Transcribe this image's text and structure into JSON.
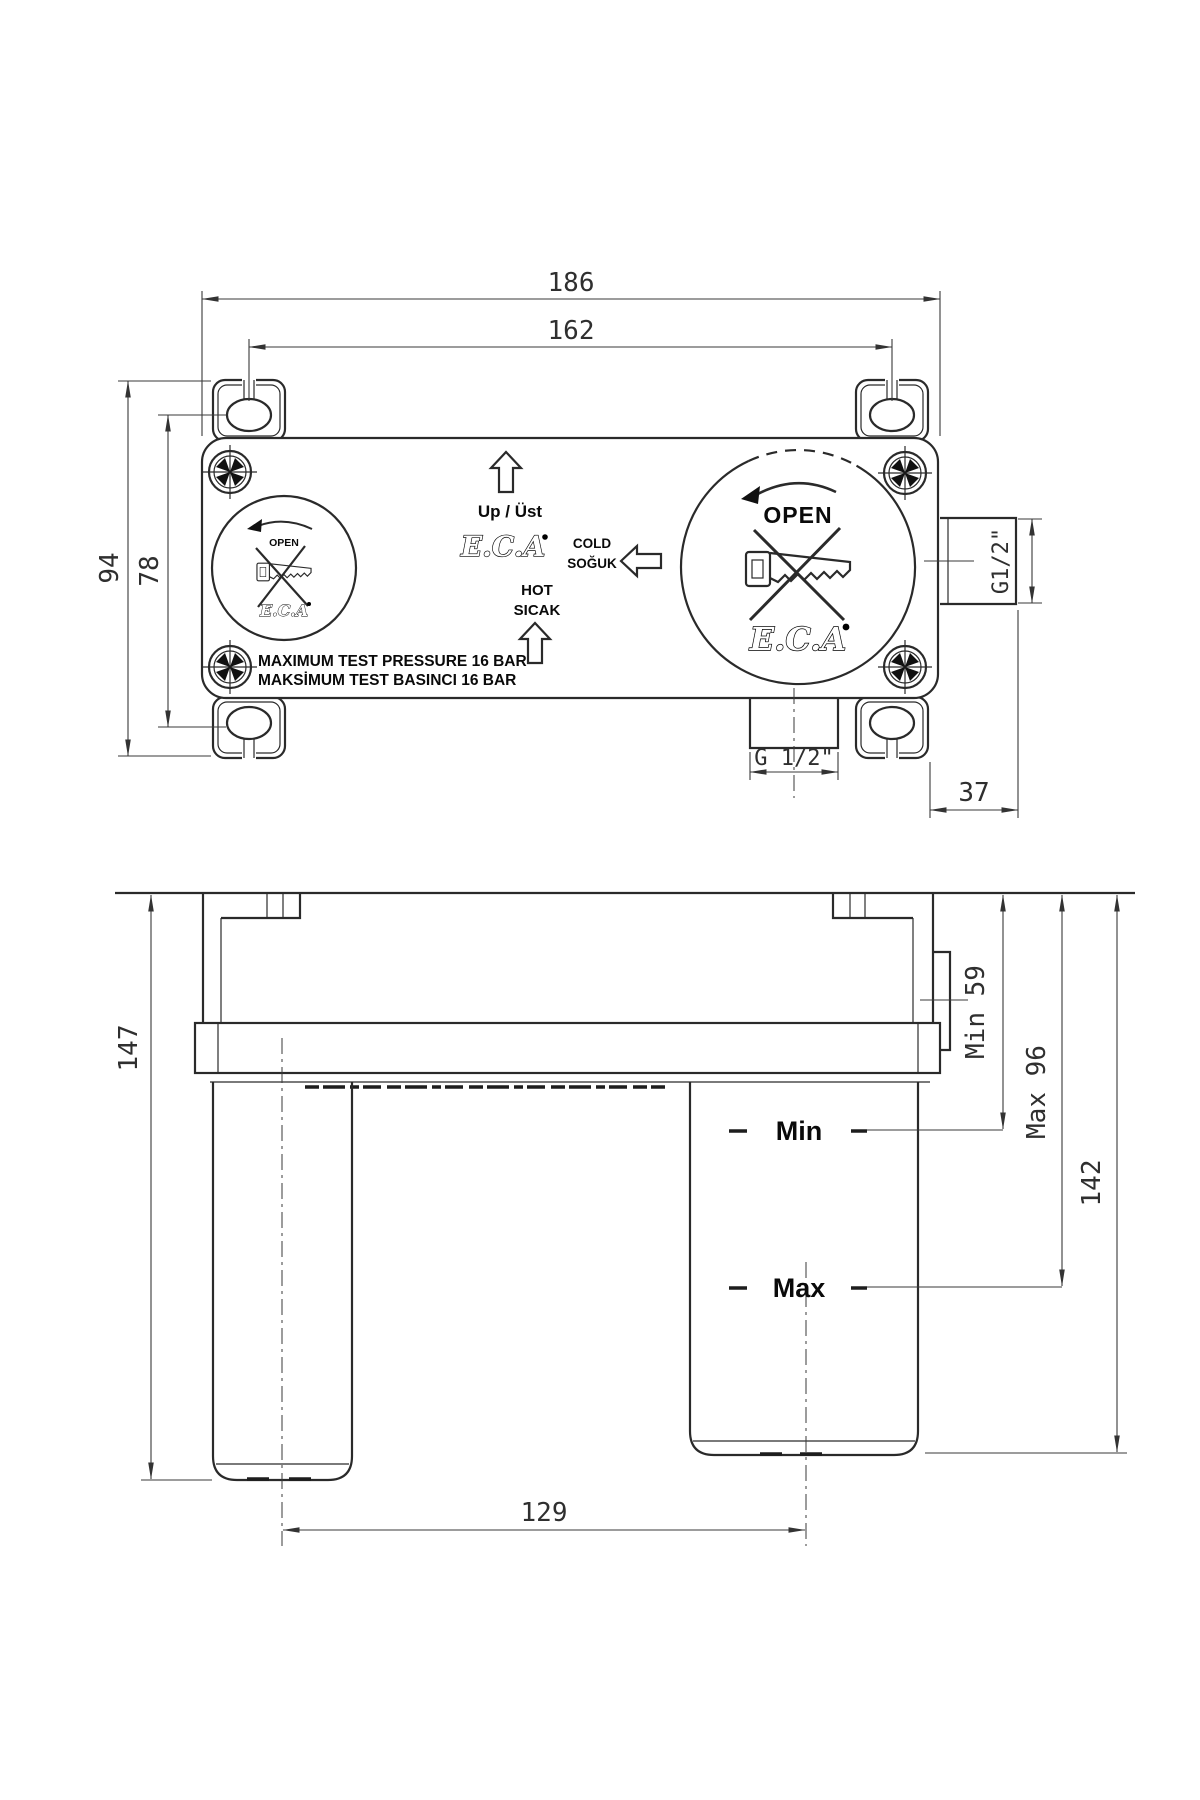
{
  "brand": {
    "name": "E.C.A"
  },
  "views": {
    "top": {
      "dims": {
        "width_overall": "186",
        "width_holes": "162",
        "height_overall": "94",
        "height_holes": "78",
        "outlet_side": "G1/2\"",
        "outlet_bottom": "G 1/2\"",
        "outlet_offset": "37"
      },
      "labels": {
        "up": "Up / Üst",
        "cold1": "COLD",
        "cold2": "SOĞUK",
        "hot1": "HOT",
        "hot2": "SICAK",
        "open": "OPEN",
        "pressure1": "MAXIMUM TEST PRESSURE 16 BAR",
        "pressure2": "MAKSİMUM TEST BASINCI 16 BAR"
      }
    },
    "front": {
      "dims": {
        "height_overall": "147",
        "depth_min": "Min 59",
        "depth_max": "Max 96",
        "depth_total": "142",
        "leg_spacing": "129"
      },
      "labels": {
        "min": "Min",
        "max": "Max"
      }
    }
  }
}
